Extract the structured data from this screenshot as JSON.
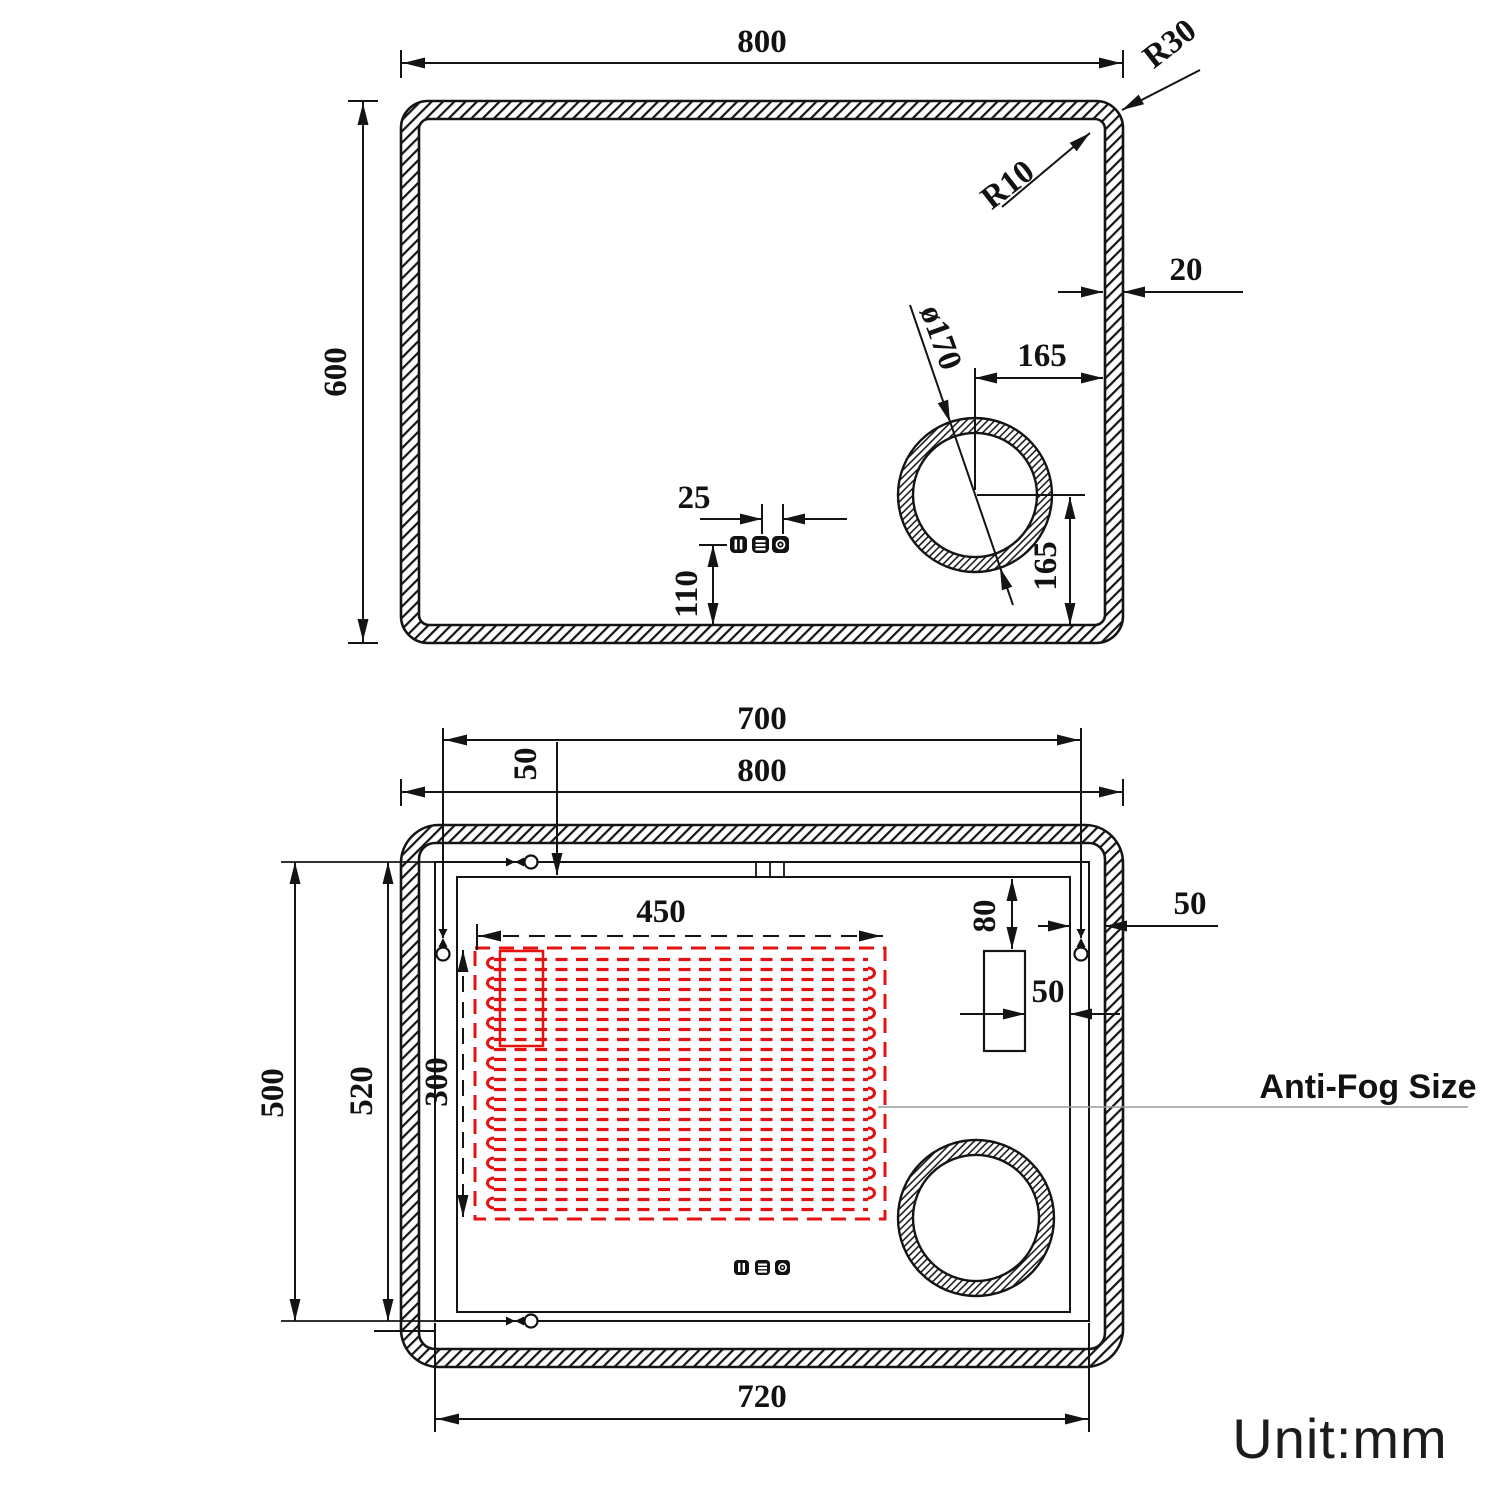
{
  "unit_label": "Unit:mm",
  "annotations": {
    "anti_fog_label": "Anti-Fog Size"
  },
  "colors": {
    "line": "#141414",
    "heater_red": "#e51010",
    "leader_gray": "#9a9a9a"
  },
  "front_view": {
    "name": "mirror front view",
    "dims": {
      "width": "800",
      "height": "600",
      "outer_corner_radius": "R30",
      "inner_corner_radius": "R10",
      "frame_thickness": "20",
      "speaker_diameter": "ø170",
      "speaker_center_to_right_edge": "165",
      "speaker_center_to_bottom_edge": "165",
      "button_pitch": "25",
      "buttons_to_bottom_edge": "110"
    }
  },
  "back_view": {
    "name": "mirror back view",
    "dims": {
      "hanger_span": "700",
      "overall_width": "800",
      "hanger_top_inset": "50",
      "heater_width": "450",
      "heater_height": "300",
      "led_top_offset": "80",
      "right_edge_inset": "50",
      "box_to_edge_gap": "50",
      "hanger_height": "500",
      "backplate_height": "520",
      "backplate_width": "720"
    }
  }
}
